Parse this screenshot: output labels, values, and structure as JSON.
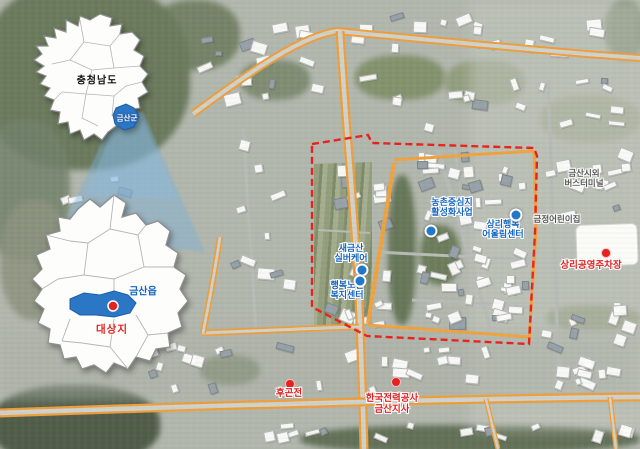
{
  "insets": {
    "province": {
      "name": "충청남도",
      "highlight": "금산군"
    },
    "county": {
      "town": "금산읍",
      "site": "대상지"
    }
  },
  "facilities": [
    {
      "line1": "농촌중심지",
      "line2": "활성화사업"
    },
    {
      "line1": "상리행복",
      "line2": "어울림센터"
    },
    {
      "line1": "새금산",
      "line2": "실버케어"
    },
    {
      "line1": "행복노인",
      "line2": "복지센터"
    }
  ],
  "pois_red": [
    {
      "line1": "후곤전",
      "line2": ""
    },
    {
      "line1": "한국전력공사",
      "line2": "금산지사"
    },
    {
      "line1": "상리공영주차장",
      "line2": ""
    }
  ],
  "pois_gray": [
    {
      "line1": "금산시외",
      "line2": "버스터미널"
    },
    {
      "line1": "금정어린이집",
      "line2": ""
    }
  ],
  "colors": {
    "boundary": "#e8231d",
    "road": "#ee9e3b",
    "facility_text": "#1565c0",
    "poi_text": "#e02424",
    "site_fill": "#2c76c6",
    "beam": "rgba(125,175,215,0.45)"
  }
}
